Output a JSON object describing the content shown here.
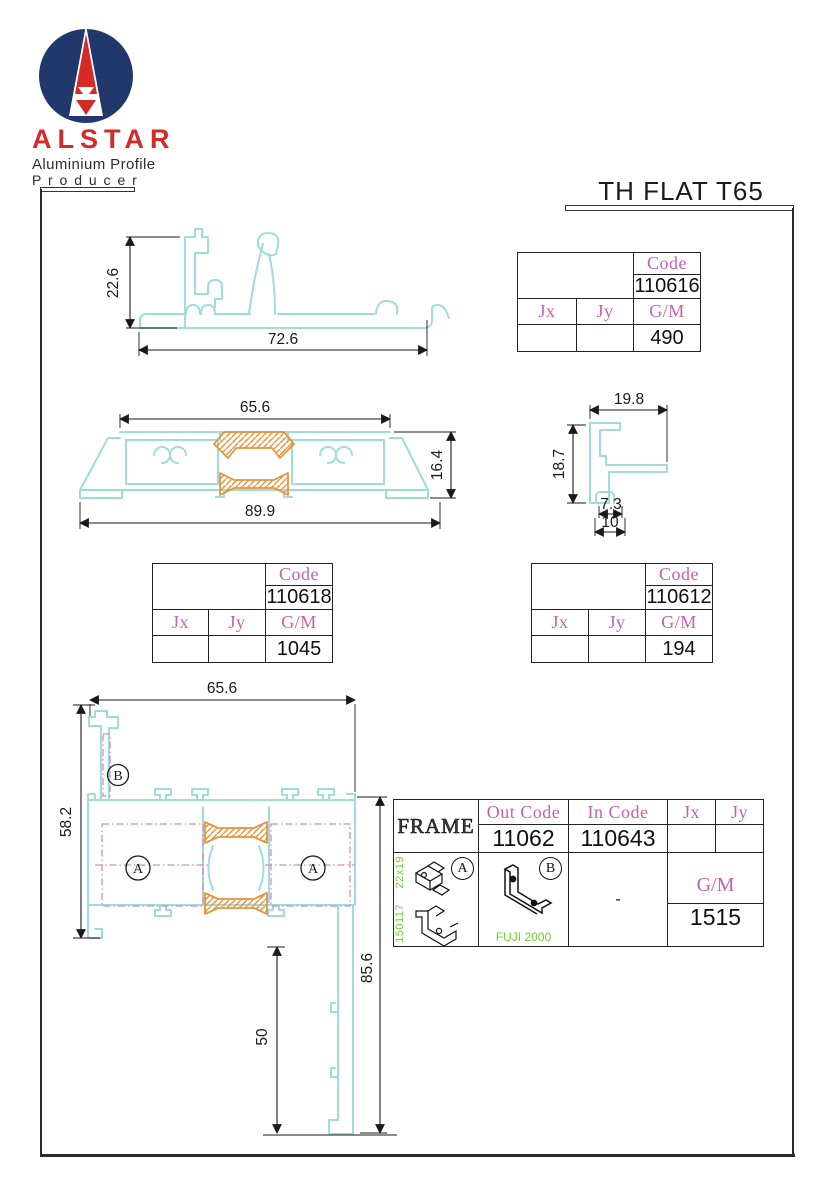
{
  "logo": {
    "brand": "ALSTAR",
    "tagline1": "Aluminium Profile",
    "tagline2": "P r o d u c e r"
  },
  "title": "TH FLAT T65",
  "colors": {
    "profile_cyan": "#9fdcdc",
    "thermal_break_orange": "#e8923a",
    "phantom_magenta": "#cf8bd0",
    "table_pink": "#c75fb1",
    "note_green": "#6fce33",
    "logo_navy": "#20386b",
    "logo_red": "#d42a28"
  },
  "drawings": {
    "threshold": {
      "height": "22.6",
      "width": "72.6"
    },
    "sill": {
      "top_width": "65.6",
      "height": "16.4",
      "bottom_width": "89.9"
    },
    "corner": {
      "top_width": "19.8",
      "height": "18.7",
      "slot_width": "7.3",
      "bottom_width": "10"
    },
    "assembly": {
      "top_width": "65.6",
      "left_height": "58.2",
      "right_height": "85.6",
      "leg_height": "50",
      "label_a": "A",
      "label_b": "B"
    }
  },
  "tables": {
    "t110616": {
      "code_label": "Code",
      "code": "110616",
      "jx_label": "Jx",
      "jy_label": "Jy",
      "gm_label": "G/M",
      "gm_value": "490"
    },
    "t110618": {
      "code_label": "Code",
      "code": "110618",
      "jx_label": "Jx",
      "jy_label": "Jy",
      "gm_label": "G/M",
      "gm_value": "1045"
    },
    "t110612": {
      "code_label": "Code",
      "code": "110612",
      "jx_label": "Jx",
      "jy_label": "Jy",
      "gm_label": "G/M",
      "gm_value": "194"
    },
    "frame": {
      "title": "FRAME",
      "out_code_label": "Out Code",
      "in_code_label": "In Code",
      "jx_label": "Jx",
      "jy_label": "Jy",
      "out_code": "11062",
      "in_code": "110643",
      "gm_label": "G/M",
      "gm_value": "1515",
      "accessory_a_label": "A",
      "accessory_b_label": "B",
      "accessory_a_size": "22x19",
      "accessory_a_code": "150117",
      "accessory_b_brand": "FUJI 2000",
      "in_code_accessory": "-"
    }
  }
}
